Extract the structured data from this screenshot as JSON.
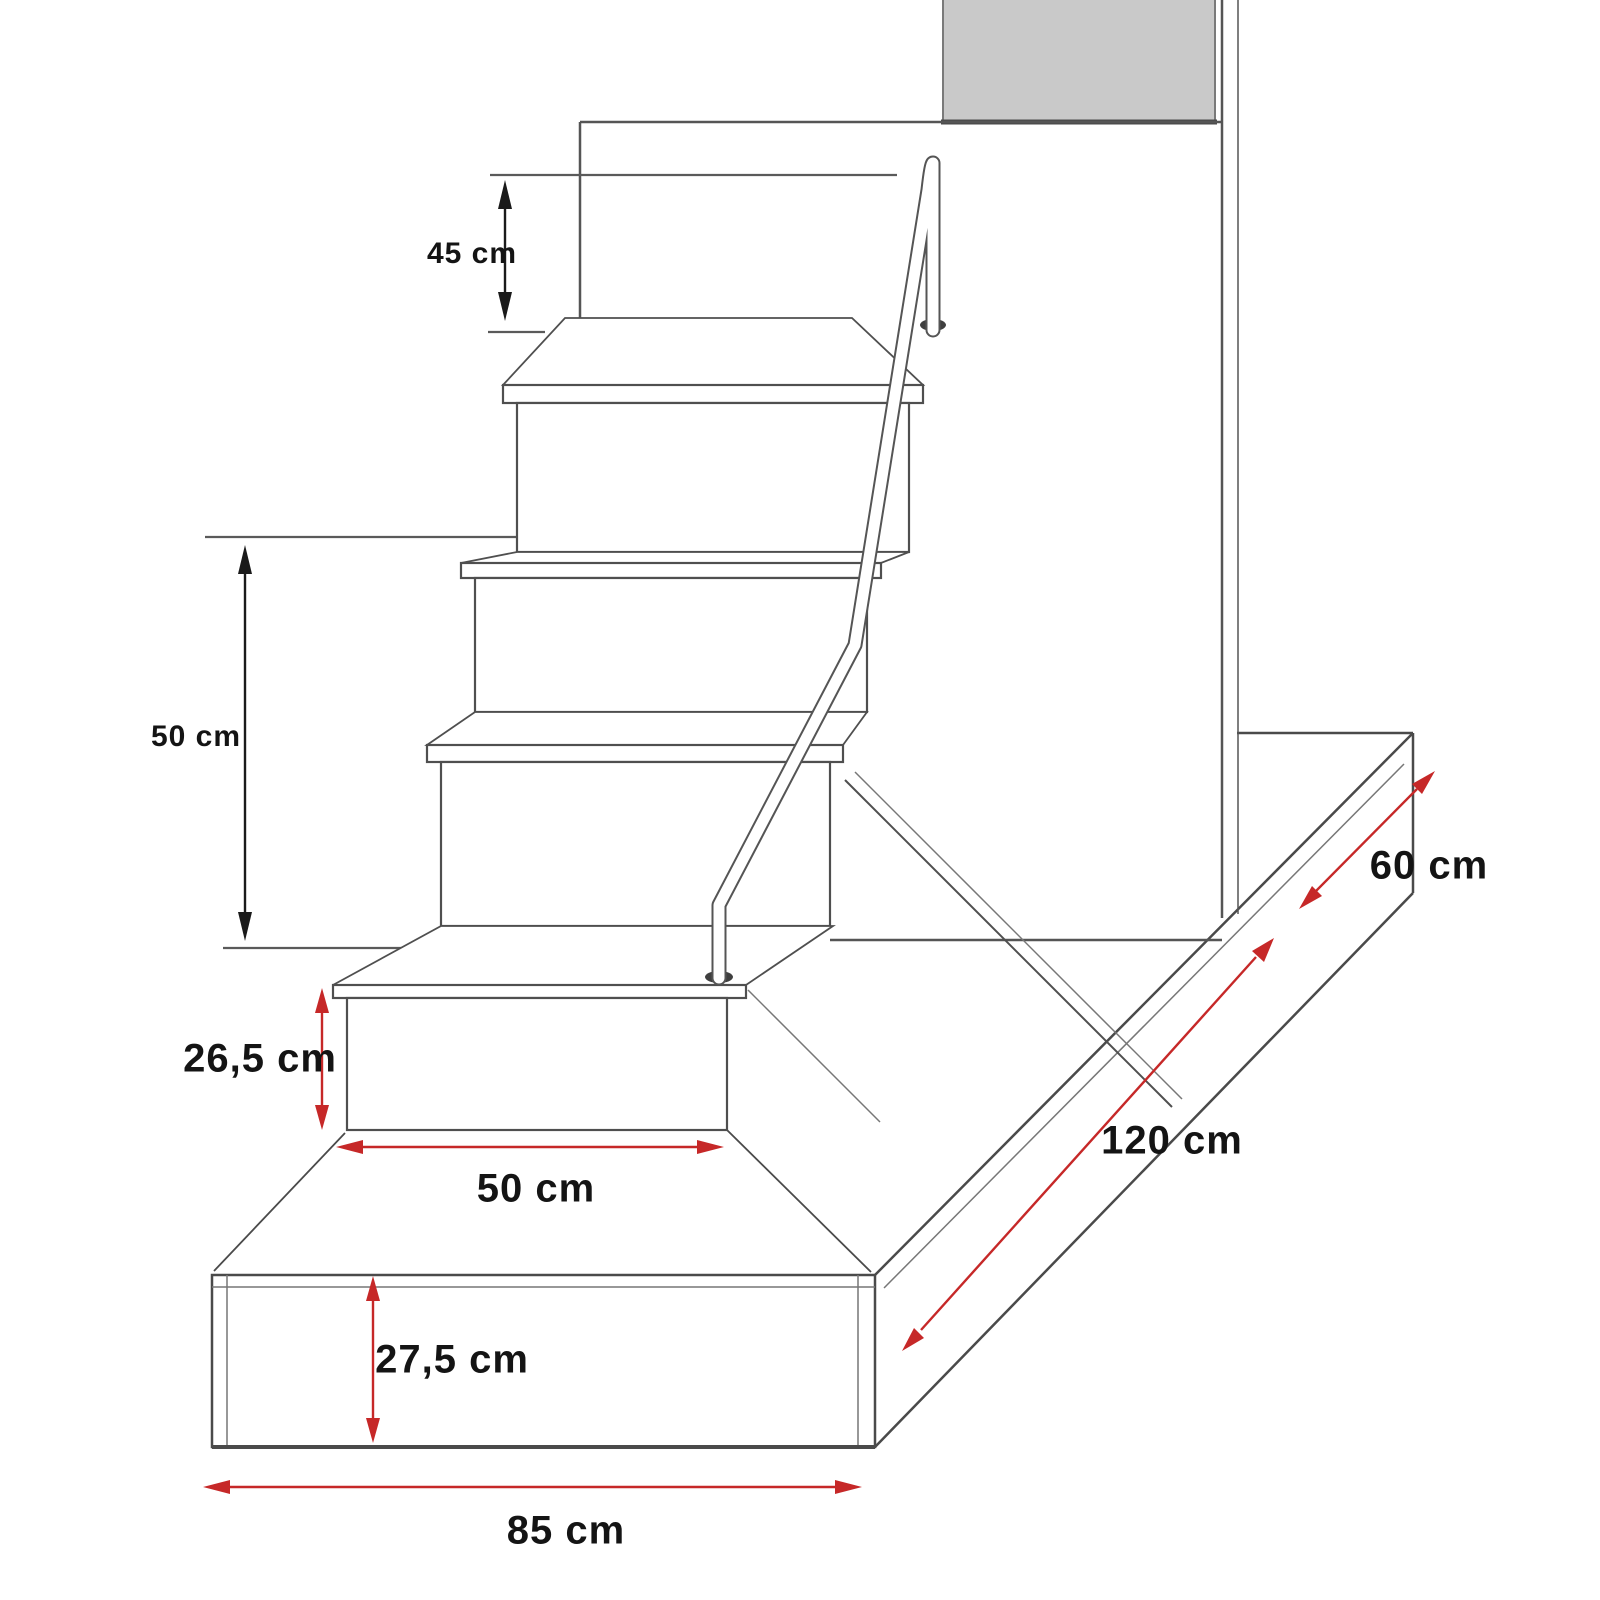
{
  "diagram": {
    "kind": "furniture dimension drawing",
    "subject": "staircase with storage steps, handrail and bed platform",
    "background_color": "#ffffff",
    "line_color": "#4f4f4f",
    "accent_red": "#c62828",
    "panel_gray": "#c9c9c9",
    "text_color": "#141414"
  },
  "dimensions": [
    {
      "label": "45 cm",
      "orientation": "vertical",
      "arrow_color": "black",
      "area": "upper left, bed level to top step"
    },
    {
      "label": "50 cm",
      "orientation": "vertical",
      "arrow_color": "black",
      "area": "mid left, stair height"
    },
    {
      "label": "26,5 cm",
      "orientation": "vertical",
      "arrow_color": "red",
      "area": "bottom step height"
    },
    {
      "label": "50 cm",
      "orientation": "horizontal",
      "arrow_color": "red",
      "area": "bottom step width"
    },
    {
      "label": "27,5 cm",
      "orientation": "vertical",
      "arrow_color": "red",
      "area": "platform front height"
    },
    {
      "label": "85 cm",
      "orientation": "horizontal",
      "arrow_color": "red",
      "area": "platform front width"
    },
    {
      "label": "60 cm",
      "orientation": "diagonal",
      "arrow_color": "red",
      "area": "platform depth behind wall"
    },
    {
      "label": "120 cm",
      "orientation": "diagonal",
      "arrow_color": "red",
      "area": "platform length"
    }
  ]
}
